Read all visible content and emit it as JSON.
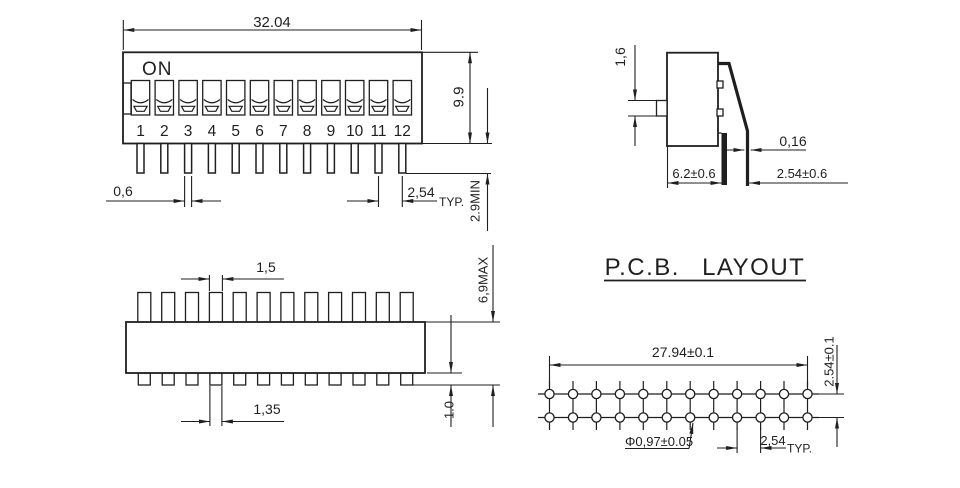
{
  "colors": {
    "background": "#ffffff",
    "line": "#1f1f1f"
  },
  "front_view": {
    "on_label": "ON",
    "positions": [
      "1",
      "2",
      "3",
      "4",
      "5",
      "6",
      "7",
      "8",
      "9",
      "10",
      "11",
      "12"
    ],
    "dim_overall_width": "32.04",
    "dim_body_height": "9.9",
    "dim_pin_width": "0,6",
    "dim_pin_pitch": "2,54",
    "dim_pin_pitch_note": "TYP.",
    "dim_pin_length": "2.9MIN"
  },
  "side_view": {
    "dim_actuator_height": "1,6",
    "dim_pin_thickness": "0,16",
    "dim_body_depth": "6.2±0.6",
    "dim_pin_row_offset": "2.54±0.6"
  },
  "bottom_view": {
    "dim_actuator_width": "1,5",
    "dim_pin_width": "1,35",
    "dim_overall_depth": "6,9MAX",
    "dim_standoff": "1.0"
  },
  "pcb_layout": {
    "title": "P.C.B. LAYOUT",
    "dim_hole_span": "27.94±0.1",
    "dim_row_pitch": "2.54±0.1",
    "dim_hole_diameter": "Φ0,97±0.05",
    "dim_hole_pitch": "2,54",
    "dim_hole_pitch_note": "TYP."
  }
}
